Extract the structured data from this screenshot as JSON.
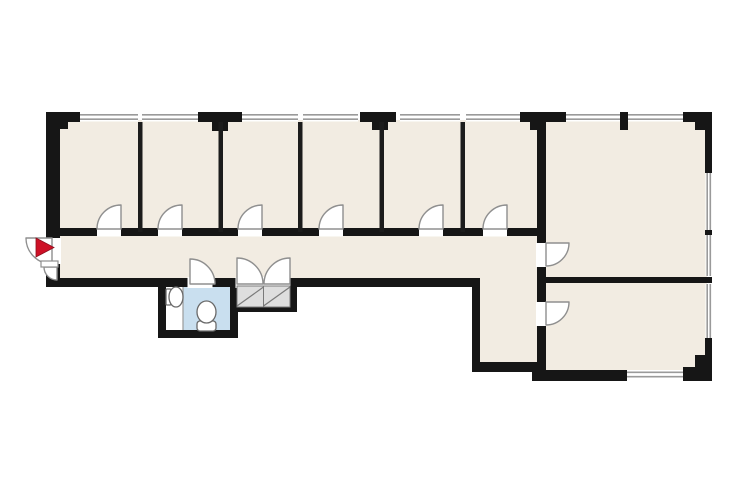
{
  "canvas": {
    "width": 740,
    "height": 493,
    "background": "#ffffff"
  },
  "palette": {
    "wall": "#161616",
    "thin_wall": "#1c1c1c",
    "room_fill": "#F2ECE2",
    "bathroom_fill": "#C9DFEF",
    "alcove_fill": "#FFFFFF",
    "closet_fill": "#DEDEDE",
    "closet_line": "#7a7a7a",
    "window_fill": "#FFFFFF",
    "window_line": "#9a9a9a",
    "door_fill": "#FFFFFF",
    "door_stroke": "#8f8f8f",
    "fixture_stroke": "#6a6a6a",
    "fixture_fill": "#FFFFFF",
    "entrance_arrow": "#CE1126"
  },
  "floor_plan": {
    "rooms": [
      {
        "name": "office-band-floor",
        "fill": "room_fill",
        "x": 60,
        "y": 120,
        "w": 477,
        "h": 162
      },
      {
        "name": "large-room-floor",
        "fill": "room_fill",
        "x": 544,
        "y": 120,
        "w": 163,
        "h": 160
      },
      {
        "name": "lower-right-room-floor",
        "fill": "room_fill",
        "x": 544,
        "y": 280,
        "w": 163,
        "h": 92
      },
      {
        "name": "lobby-floor",
        "fill": "room_fill",
        "x": 478,
        "y": 278,
        "w": 61,
        "h": 86
      },
      {
        "name": "bathroom-floor",
        "fill": "bathroom_fill",
        "x": 183,
        "y": 285,
        "w": 47,
        "h": 46
      },
      {
        "name": "bathroom-alcove-floor",
        "fill": "alcove_fill",
        "x": 166,
        "y": 285,
        "w": 17,
        "h": 46
      }
    ],
    "windows": [
      {
        "name": "window-top-1",
        "dir": "h",
        "x": 80,
        "y": 112.5,
        "w": 58,
        "h": 9
      },
      {
        "name": "window-top-2",
        "dir": "h",
        "x": 142,
        "y": 112.5,
        "w": 56,
        "h": 9
      },
      {
        "name": "window-top-3",
        "dir": "h",
        "x": 242,
        "y": 112.5,
        "w": 56,
        "h": 9
      },
      {
        "name": "window-top-4",
        "dir": "h",
        "x": 303,
        "y": 112.5,
        "w": 55,
        "h": 9
      },
      {
        "name": "window-top-5",
        "dir": "h",
        "x": 400,
        "y": 112.5,
        "w": 60,
        "h": 9
      },
      {
        "name": "window-top-6",
        "dir": "h",
        "x": 466,
        "y": 112.5,
        "w": 54,
        "h": 9
      },
      {
        "name": "window-top-7",
        "dir": "h",
        "x": 566,
        "y": 112.5,
        "w": 54,
        "h": 9
      },
      {
        "name": "window-top-8",
        "dir": "h",
        "x": 628,
        "y": 112.5,
        "w": 55,
        "h": 9
      },
      {
        "name": "window-right-1",
        "dir": "v",
        "x": 705.5,
        "y": 173,
        "w": 6.5,
        "h": 57
      },
      {
        "name": "window-right-2",
        "dir": "v",
        "x": 705.5,
        "y": 235,
        "w": 6.5,
        "h": 41
      },
      {
        "name": "window-right-3",
        "dir": "v",
        "x": 705.5,
        "y": 284,
        "w": 6.5,
        "h": 54
      },
      {
        "name": "window-bottom-1",
        "dir": "h",
        "x": 627,
        "y": 370,
        "w": 60,
        "h": 9
      }
    ],
    "walls": [
      {
        "name": "outer-left-wall",
        "x": 46,
        "y": 112,
        "w": 14,
        "h": 175
      },
      {
        "name": "top-left-corner-a",
        "x": 46,
        "y": 112,
        "w": 34,
        "h": 10
      },
      {
        "name": "top-left-corner-b",
        "x": 46,
        "y": 122,
        "w": 22,
        "h": 7
      },
      {
        "name": "top-pillar-1",
        "x": 198,
        "y": 112,
        "w": 44,
        "h": 10
      },
      {
        "name": "top-pillar-1-stub",
        "x": 212,
        "y": 122,
        "w": 16,
        "h": 9
      },
      {
        "name": "top-pillar-2",
        "x": 360,
        "y": 112,
        "w": 36,
        "h": 10
      },
      {
        "name": "top-pillar-2-stub",
        "x": 372,
        "y": 122,
        "w": 16,
        "h": 8
      },
      {
        "name": "top-pillar-3",
        "x": 520,
        "y": 112,
        "w": 46,
        "h": 10
      },
      {
        "name": "top-pillar-3-stub",
        "x": 530,
        "y": 122,
        "w": 16,
        "h": 8
      },
      {
        "name": "large-room-top-stub",
        "x": 620,
        "y": 112,
        "w": 8,
        "h": 18
      },
      {
        "name": "top-right-corner-a",
        "x": 683,
        "y": 112,
        "w": 29,
        "h": 10
      },
      {
        "name": "top-right-corner-b",
        "x": 695,
        "y": 122,
        "w": 17,
        "h": 8
      },
      {
        "name": "right-wall-upper",
        "x": 705,
        "y": 112,
        "w": 7,
        "h": 61
      },
      {
        "name": "right-wall-tick",
        "x": 705,
        "y": 230,
        "w": 7,
        "h": 5
      },
      {
        "name": "right-wall-lower",
        "x": 705,
        "y": 338,
        "w": 7,
        "h": 43
      },
      {
        "name": "bottom-right-corner-a",
        "x": 695,
        "y": 355,
        "w": 17,
        "h": 26
      },
      {
        "name": "bottom-right-corner-b",
        "x": 683,
        "y": 367,
        "w": 29,
        "h": 14
      },
      {
        "name": "offices-bottom-wall",
        "x": 60,
        "y": 228,
        "w": 486,
        "h": 8
      },
      {
        "name": "corridor-bottom-wall",
        "x": 46,
        "y": 278,
        "w": 434,
        "h": 9
      },
      {
        "name": "step-down-wall",
        "x": 472,
        "y": 278,
        "w": 8,
        "h": 94
      },
      {
        "name": "lobby-bottom-wall",
        "x": 472,
        "y": 362,
        "w": 74,
        "h": 10
      },
      {
        "name": "bathroom-left-wall",
        "x": 158,
        "y": 278,
        "w": 8,
        "h": 60
      },
      {
        "name": "bathroom-bottom-wall",
        "x": 158,
        "y": 330,
        "w": 80,
        "h": 8
      },
      {
        "name": "bathroom-right-wall",
        "x": 230,
        "y": 287,
        "w": 8,
        "h": 43
      },
      {
        "name": "closet-bottom-wall",
        "x": 230,
        "y": 305,
        "w": 67,
        "h": 7
      },
      {
        "name": "closet-right-wall",
        "x": 290,
        "y": 287,
        "w": 7,
        "h": 25
      },
      {
        "name": "large-room-left-wall",
        "x": 537,
        "y": 112,
        "w": 9,
        "h": 269
      },
      {
        "name": "right-rooms-divider-wall",
        "x": 546,
        "y": 277,
        "w": 166,
        "h": 6
      },
      {
        "name": "bottom-wall-left-of-window",
        "x": 532,
        "y": 370,
        "w": 95,
        "h": 11
      },
      {
        "name": "bottom-wall-right-of-window",
        "x": 687,
        "y": 370,
        "w": 25,
        "h": 11
      }
    ],
    "thin_walls": [
      {
        "name": "office-divider-1",
        "x": 138,
        "y": 122,
        "w": 4.5,
        "h": 110
      },
      {
        "name": "office-divider-2",
        "x": 218.5,
        "y": 122,
        "w": 4.5,
        "h": 110
      },
      {
        "name": "office-divider-3",
        "x": 298,
        "y": 122,
        "w": 4.5,
        "h": 110
      },
      {
        "name": "office-divider-4",
        "x": 379.5,
        "y": 122,
        "w": 4.5,
        "h": 110
      },
      {
        "name": "office-divider-5",
        "x": 460.5,
        "y": 122,
        "w": 4.5,
        "h": 110
      }
    ],
    "door_gaps": [
      {
        "name": "office-door-gap-1",
        "x": 97,
        "y": 227.5,
        "w": 24,
        "h": 9
      },
      {
        "name": "office-door-gap-2",
        "x": 158,
        "y": 227.5,
        "w": 24,
        "h": 9
      },
      {
        "name": "office-door-gap-3",
        "x": 238,
        "y": 227.5,
        "w": 24,
        "h": 9
      },
      {
        "name": "office-door-gap-4",
        "x": 319,
        "y": 227.5,
        "w": 24,
        "h": 9
      },
      {
        "name": "office-door-gap-5",
        "x": 419,
        "y": 227.5,
        "w": 24,
        "h": 9
      },
      {
        "name": "office-door-gap-6",
        "x": 483,
        "y": 227.5,
        "w": 24,
        "h": 9
      },
      {
        "name": "bathroom-door-gap",
        "x": 187.5,
        "y": 277,
        "w": 25,
        "h": 11
      },
      {
        "name": "closet-door-gap",
        "x": 235.5,
        "y": 277,
        "w": 55,
        "h": 11
      },
      {
        "name": "large-room-door-gap",
        "x": 536,
        "y": 243,
        "w": 11,
        "h": 24
      },
      {
        "name": "lower-room-door-gap",
        "x": 536,
        "y": 302,
        "w": 11,
        "h": 24
      },
      {
        "name": "entrance-gap",
        "x": 44,
        "y": 238,
        "w": 17,
        "h": 26
      }
    ],
    "doors": [
      {
        "name": "office-door-1",
        "hinge": [
          121,
          229
        ],
        "r": 24,
        "leaf_deg": -90,
        "jamb_deg": 180,
        "sweep": 0
      },
      {
        "name": "office-door-2",
        "hinge": [
          182,
          229
        ],
        "r": 24,
        "leaf_deg": -90,
        "jamb_deg": 180,
        "sweep": 0
      },
      {
        "name": "office-door-3",
        "hinge": [
          262,
          229
        ],
        "r": 24,
        "leaf_deg": -90,
        "jamb_deg": 180,
        "sweep": 0
      },
      {
        "name": "office-door-4",
        "hinge": [
          343,
          229
        ],
        "r": 24,
        "leaf_deg": -90,
        "jamb_deg": 180,
        "sweep": 0
      },
      {
        "name": "office-door-5",
        "hinge": [
          443,
          229
        ],
        "r": 24,
        "leaf_deg": -90,
        "jamb_deg": 180,
        "sweep": 0
      },
      {
        "name": "office-door-6",
        "hinge": [
          507,
          229
        ],
        "r": 24,
        "leaf_deg": -90,
        "jamb_deg": 180,
        "sweep": 0
      },
      {
        "name": "bathroom-door",
        "hinge": [
          190,
          284
        ],
        "r": 25,
        "leaf_deg": -90,
        "jamb_deg": 0,
        "sweep": 1
      },
      {
        "name": "closet-door-left",
        "hinge": [
          237,
          284
        ],
        "r": 26,
        "leaf_deg": -90,
        "jamb_deg": 0,
        "sweep": 1
      },
      {
        "name": "closet-door-right",
        "hinge": [
          290,
          284
        ],
        "r": 26,
        "leaf_deg": -90,
        "jamb_deg": 180,
        "sweep": 0
      },
      {
        "name": "large-room-door",
        "hinge": [
          546,
          243
        ],
        "r": 23,
        "leaf_deg": 0,
        "jamb_deg": 90,
        "sweep": 1
      },
      {
        "name": "lower-room-door",
        "hinge": [
          546,
          302
        ],
        "r": 23,
        "leaf_deg": 0,
        "jamb_deg": 90,
        "sweep": 1
      },
      {
        "name": "entrance-door-main",
        "hinge": [
          52,
          238
        ],
        "r": 26,
        "leaf_deg": 180,
        "jamb_deg": 90,
        "sweep": 0
      },
      {
        "name": "entrance-door-small",
        "hinge": [
          57,
          267
        ],
        "r": 13,
        "leaf_deg": 180,
        "jamb_deg": 90,
        "sweep": 0
      }
    ],
    "closet": {
      "panels": [
        {
          "name": "closet-panel-1",
          "x": 237,
          "y": 286,
          "w": 26.5,
          "h": 21
        },
        {
          "name": "closet-panel-2",
          "x": 263.5,
          "y": 286,
          "w": 26.5,
          "h": 21
        }
      ],
      "diagonals": [
        {
          "x1": 237,
          "y1": 306,
          "x2": 263.5,
          "y2": 287
        },
        {
          "x1": 263.5,
          "y1": 306,
          "x2": 290,
          "y2": 287
        }
      ]
    },
    "fixtures": [
      {
        "name": "sink",
        "shapes": [
          {
            "type": "rect",
            "x": 166,
            "y": 289,
            "w": 5,
            "h": 16,
            "rx": 1
          },
          {
            "type": "ellipse",
            "cx": 176,
            "cy": 297,
            "rx": 7,
            "ry": 10
          }
        ]
      },
      {
        "name": "toilet",
        "shapes": [
          {
            "type": "rect",
            "x": 197,
            "y": 321,
            "w": 19,
            "h": 10,
            "rx": 3
          },
          {
            "type": "ellipse",
            "cx": 206.5,
            "cy": 312,
            "rx": 9.5,
            "ry": 11
          }
        ]
      }
    ],
    "entrance": {
      "arrow_points": "36,238 54,247.5 36,257",
      "leaf_rect": {
        "x": 41,
        "y": 261,
        "w": 17,
        "h": 6
      }
    }
  }
}
